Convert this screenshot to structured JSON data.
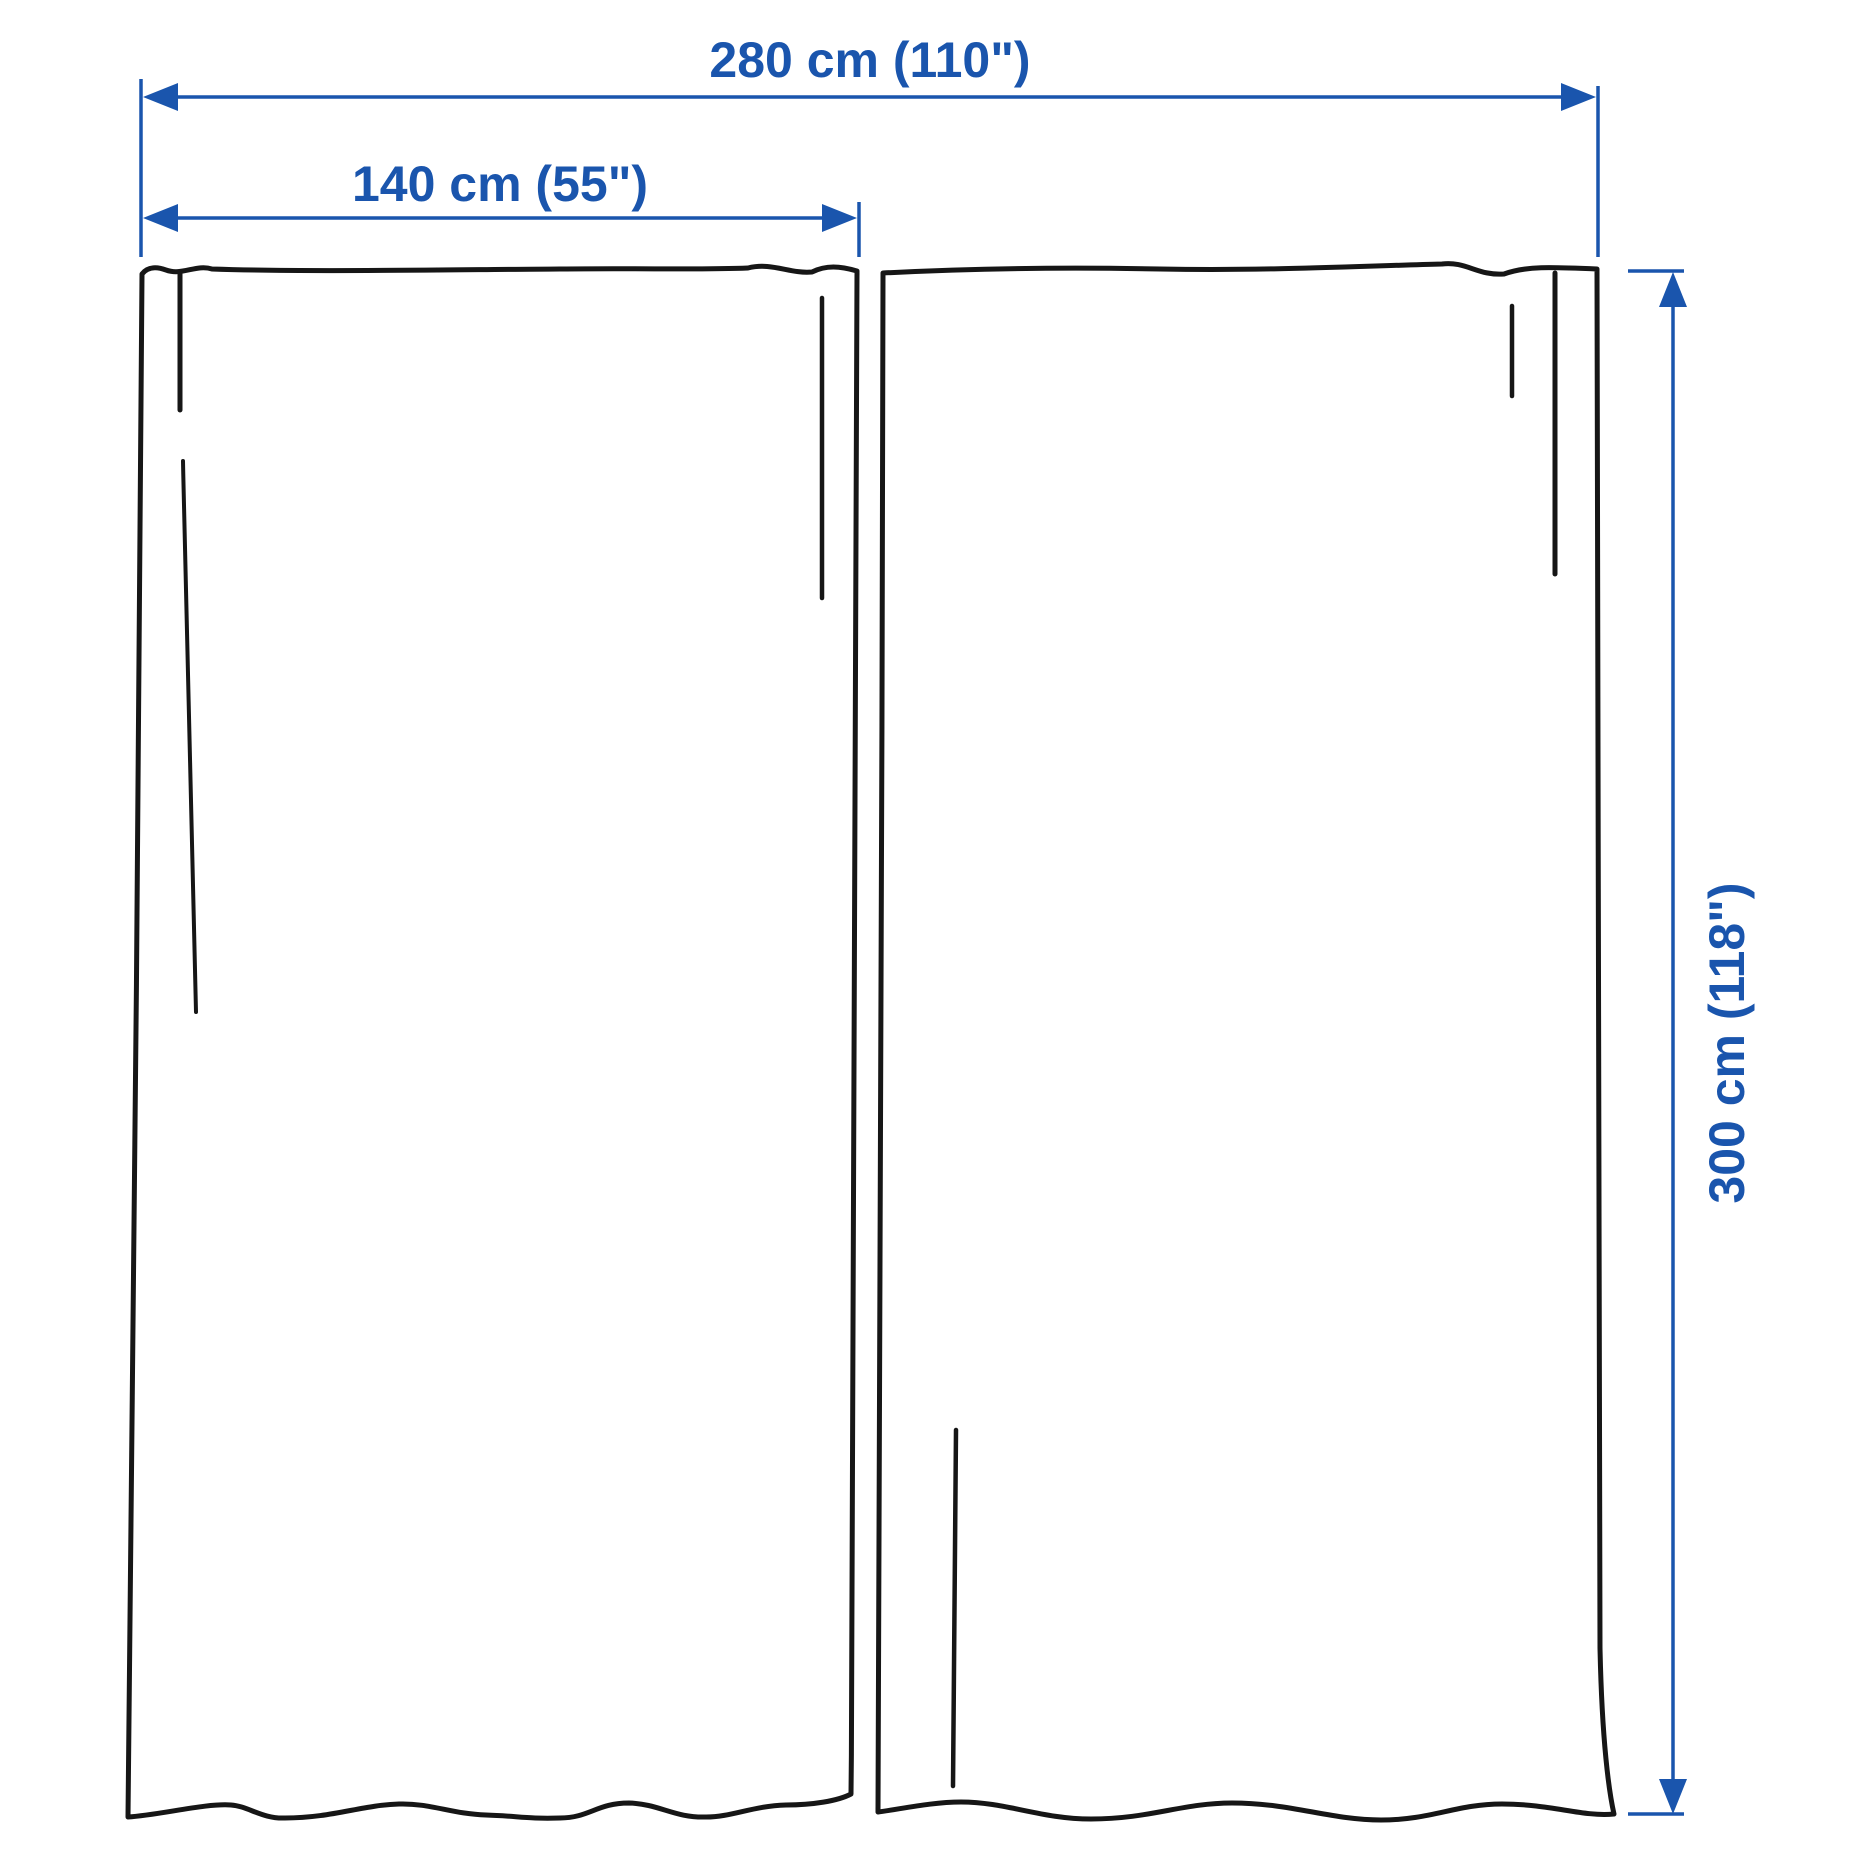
{
  "diagram": {
    "dimensions": {
      "total_width": {
        "label": "280 cm (110\")",
        "value_cm": 280,
        "value_in": 110,
        "orientation": "horizontal"
      },
      "panel_width": {
        "label": "140 cm (55\")",
        "value_cm": 140,
        "value_in": 55,
        "orientation": "horizontal"
      },
      "height": {
        "label": "300 cm (118\")",
        "value_cm": 300,
        "value_in": 118,
        "orientation": "vertical"
      }
    },
    "panels": {
      "count": 2
    },
    "colors": {
      "dimension": "#1a55ad",
      "outline": "#161616",
      "background": "#ffffff"
    }
  }
}
